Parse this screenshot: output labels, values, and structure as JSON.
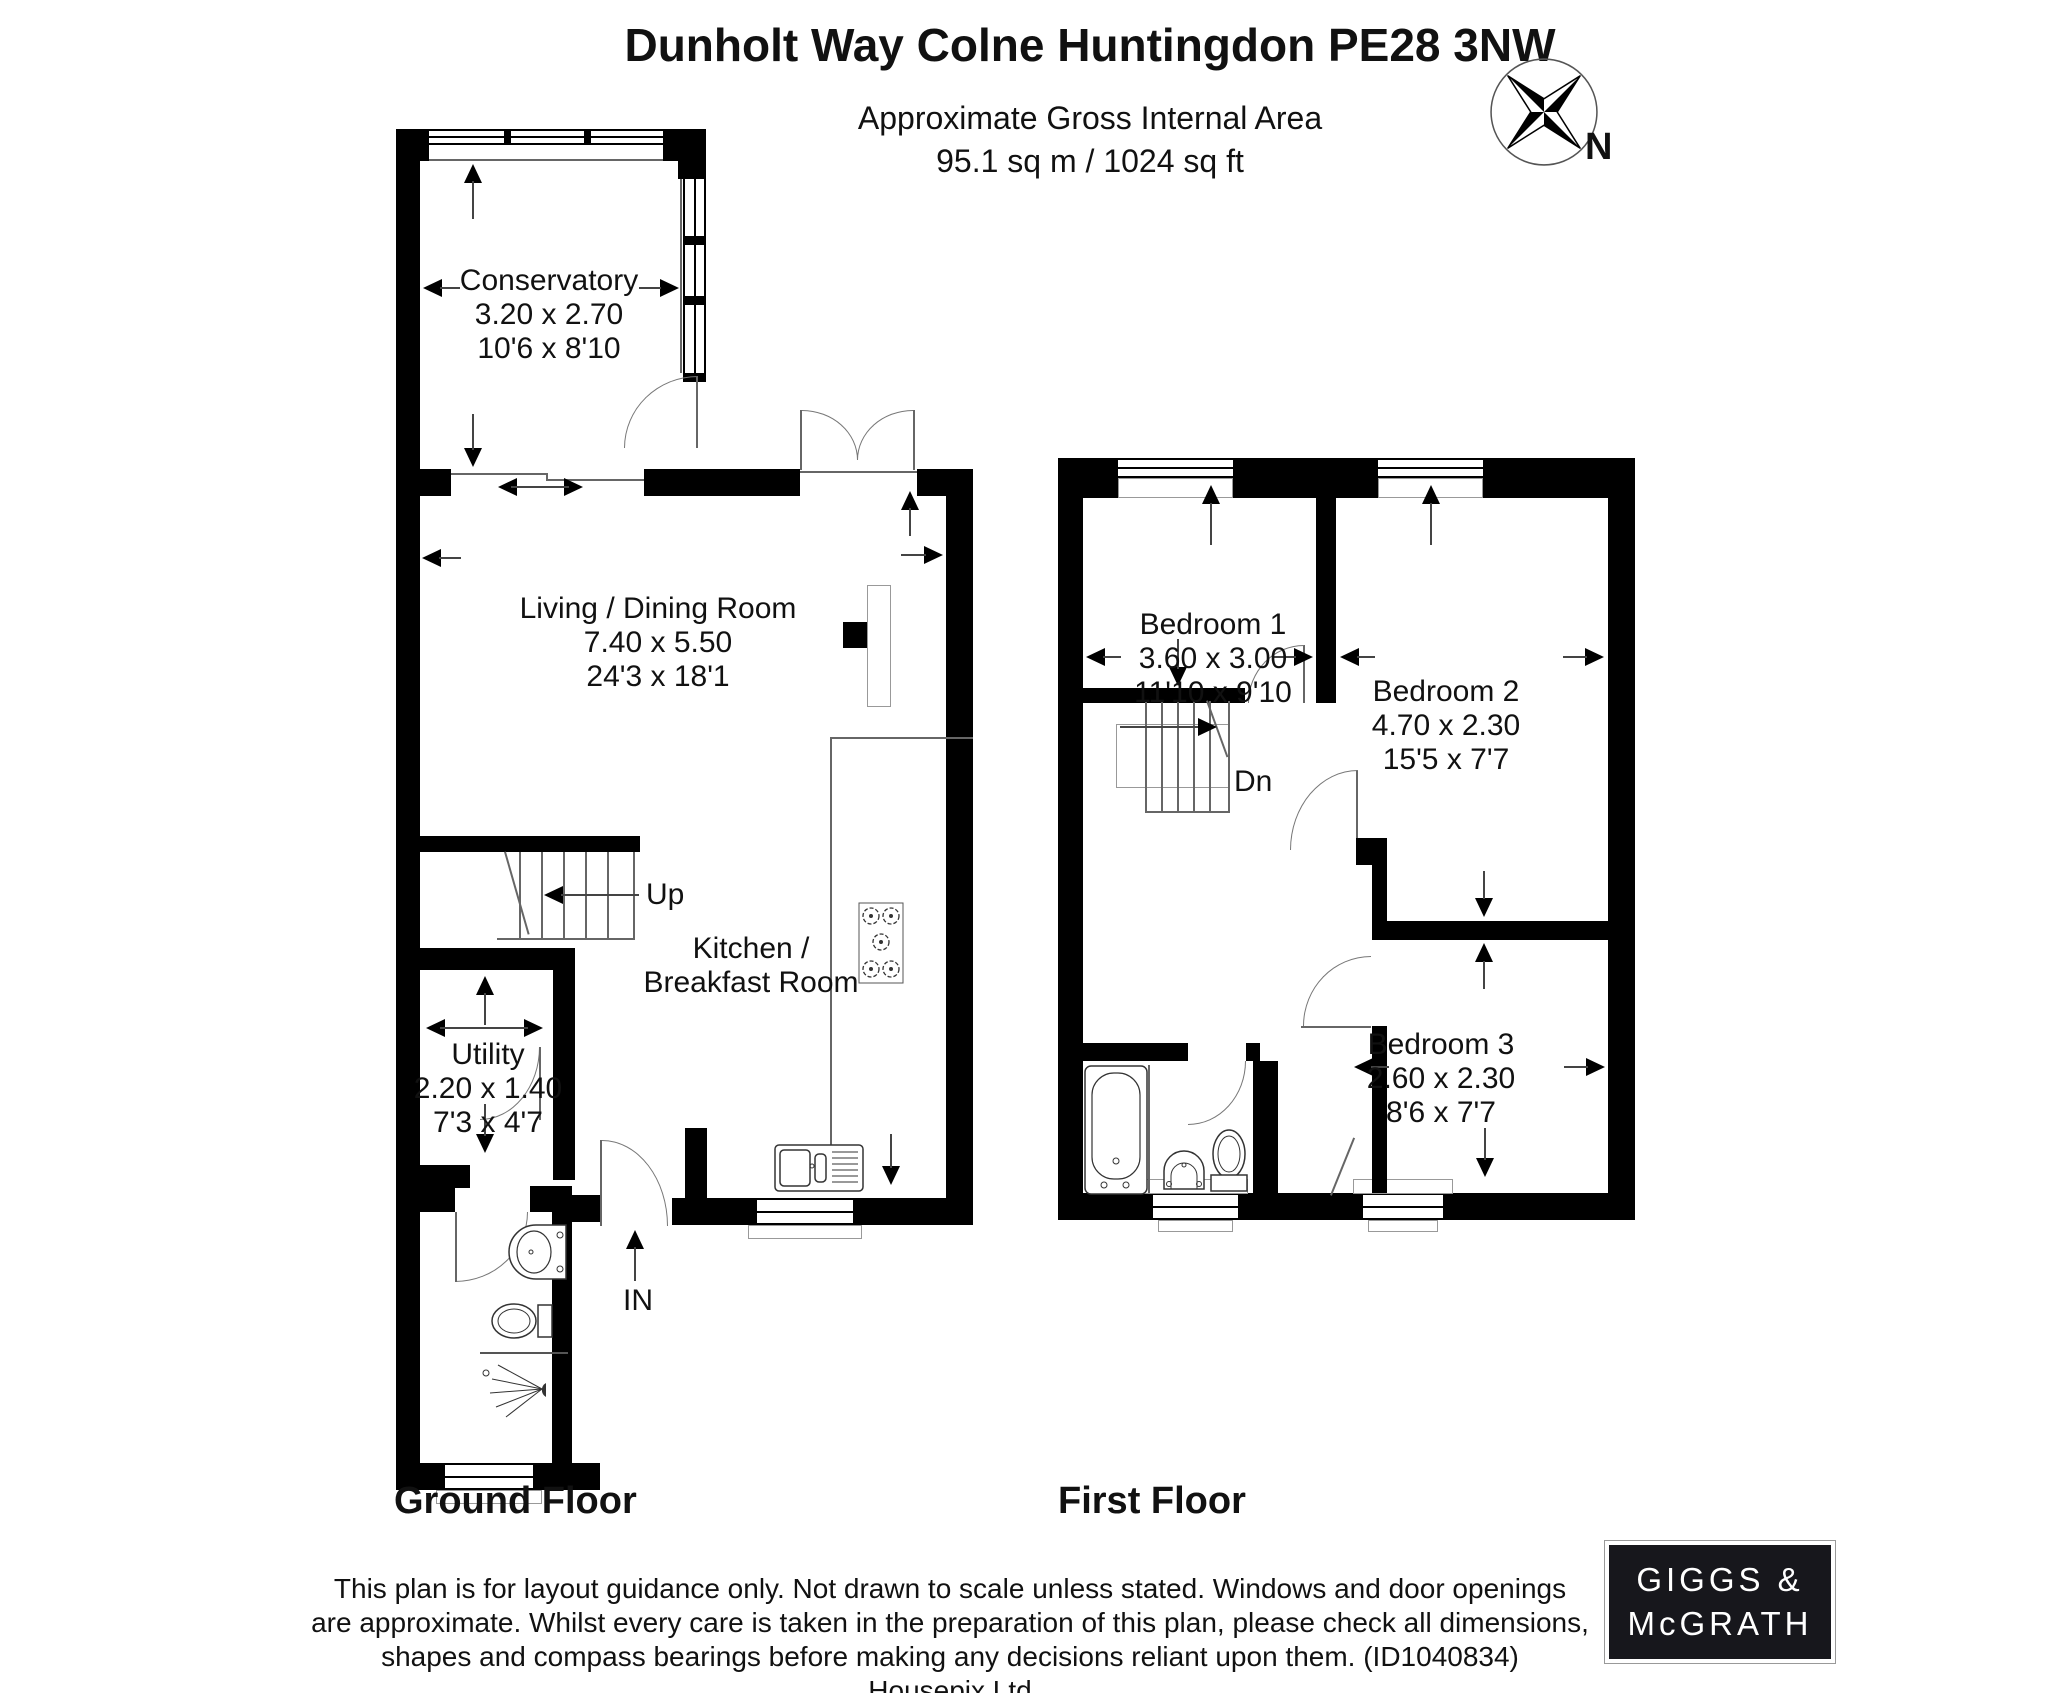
{
  "header": {
    "title": "Dunholt Way Colne Huntingdon PE28 3NW",
    "subtitle_line1": "Approximate Gross Internal Area",
    "subtitle_line2": "95.1 sq m / 1024 sq ft"
  },
  "compass": {
    "label": "N"
  },
  "ground_floor": {
    "label": "Ground Floor",
    "stairs_label": "Up",
    "entrance_label": "IN",
    "rooms": {
      "conservatory": {
        "name": "Conservatory",
        "metric": "3.20 x 2.70",
        "imperial": "10'6 x 8'10"
      },
      "living_dining": {
        "name": "Living / Dining Room",
        "metric": "7.40 x 5.50",
        "imperial": "24'3 x 18'1"
      },
      "kitchen": {
        "name_line1": "Kitchen /",
        "name_line2": "Breakfast Room"
      },
      "utility": {
        "name": "Utility",
        "metric": "2.20 x 1.40",
        "imperial": "7'3 x 4'7"
      }
    }
  },
  "first_floor": {
    "label": "First Floor",
    "stairs_label": "Dn",
    "rooms": {
      "bedroom1": {
        "name": "Bedroom 1",
        "metric": "3.60 x 3.00",
        "imperial": "11'10 x 9'10"
      },
      "bedroom2": {
        "name": "Bedroom 2",
        "metric": "4.70 x 2.30",
        "imperial": "15'5 x 7'7"
      },
      "bedroom3": {
        "name": "Bedroom 3",
        "metric": "2.60 x 2.30",
        "imperial": "8'6 x 7'7"
      }
    }
  },
  "footer": {
    "line1": "This plan is for layout guidance only. Not drawn to scale unless stated. Windows and door openings",
    "line2": "are approximate. Whilst every care is taken in the preparation of this plan, please check all dimensions,",
    "line3": "shapes and compass bearings before making any decisions reliant upon them. (ID1040834)",
    "line4": "Housepix Ltd"
  },
  "logo": {
    "line1": "GIGGS &",
    "line2": "McGRATH"
  },
  "colors": {
    "wall": "#000000",
    "line": "#666666",
    "logo_bg": "#17171c"
  }
}
